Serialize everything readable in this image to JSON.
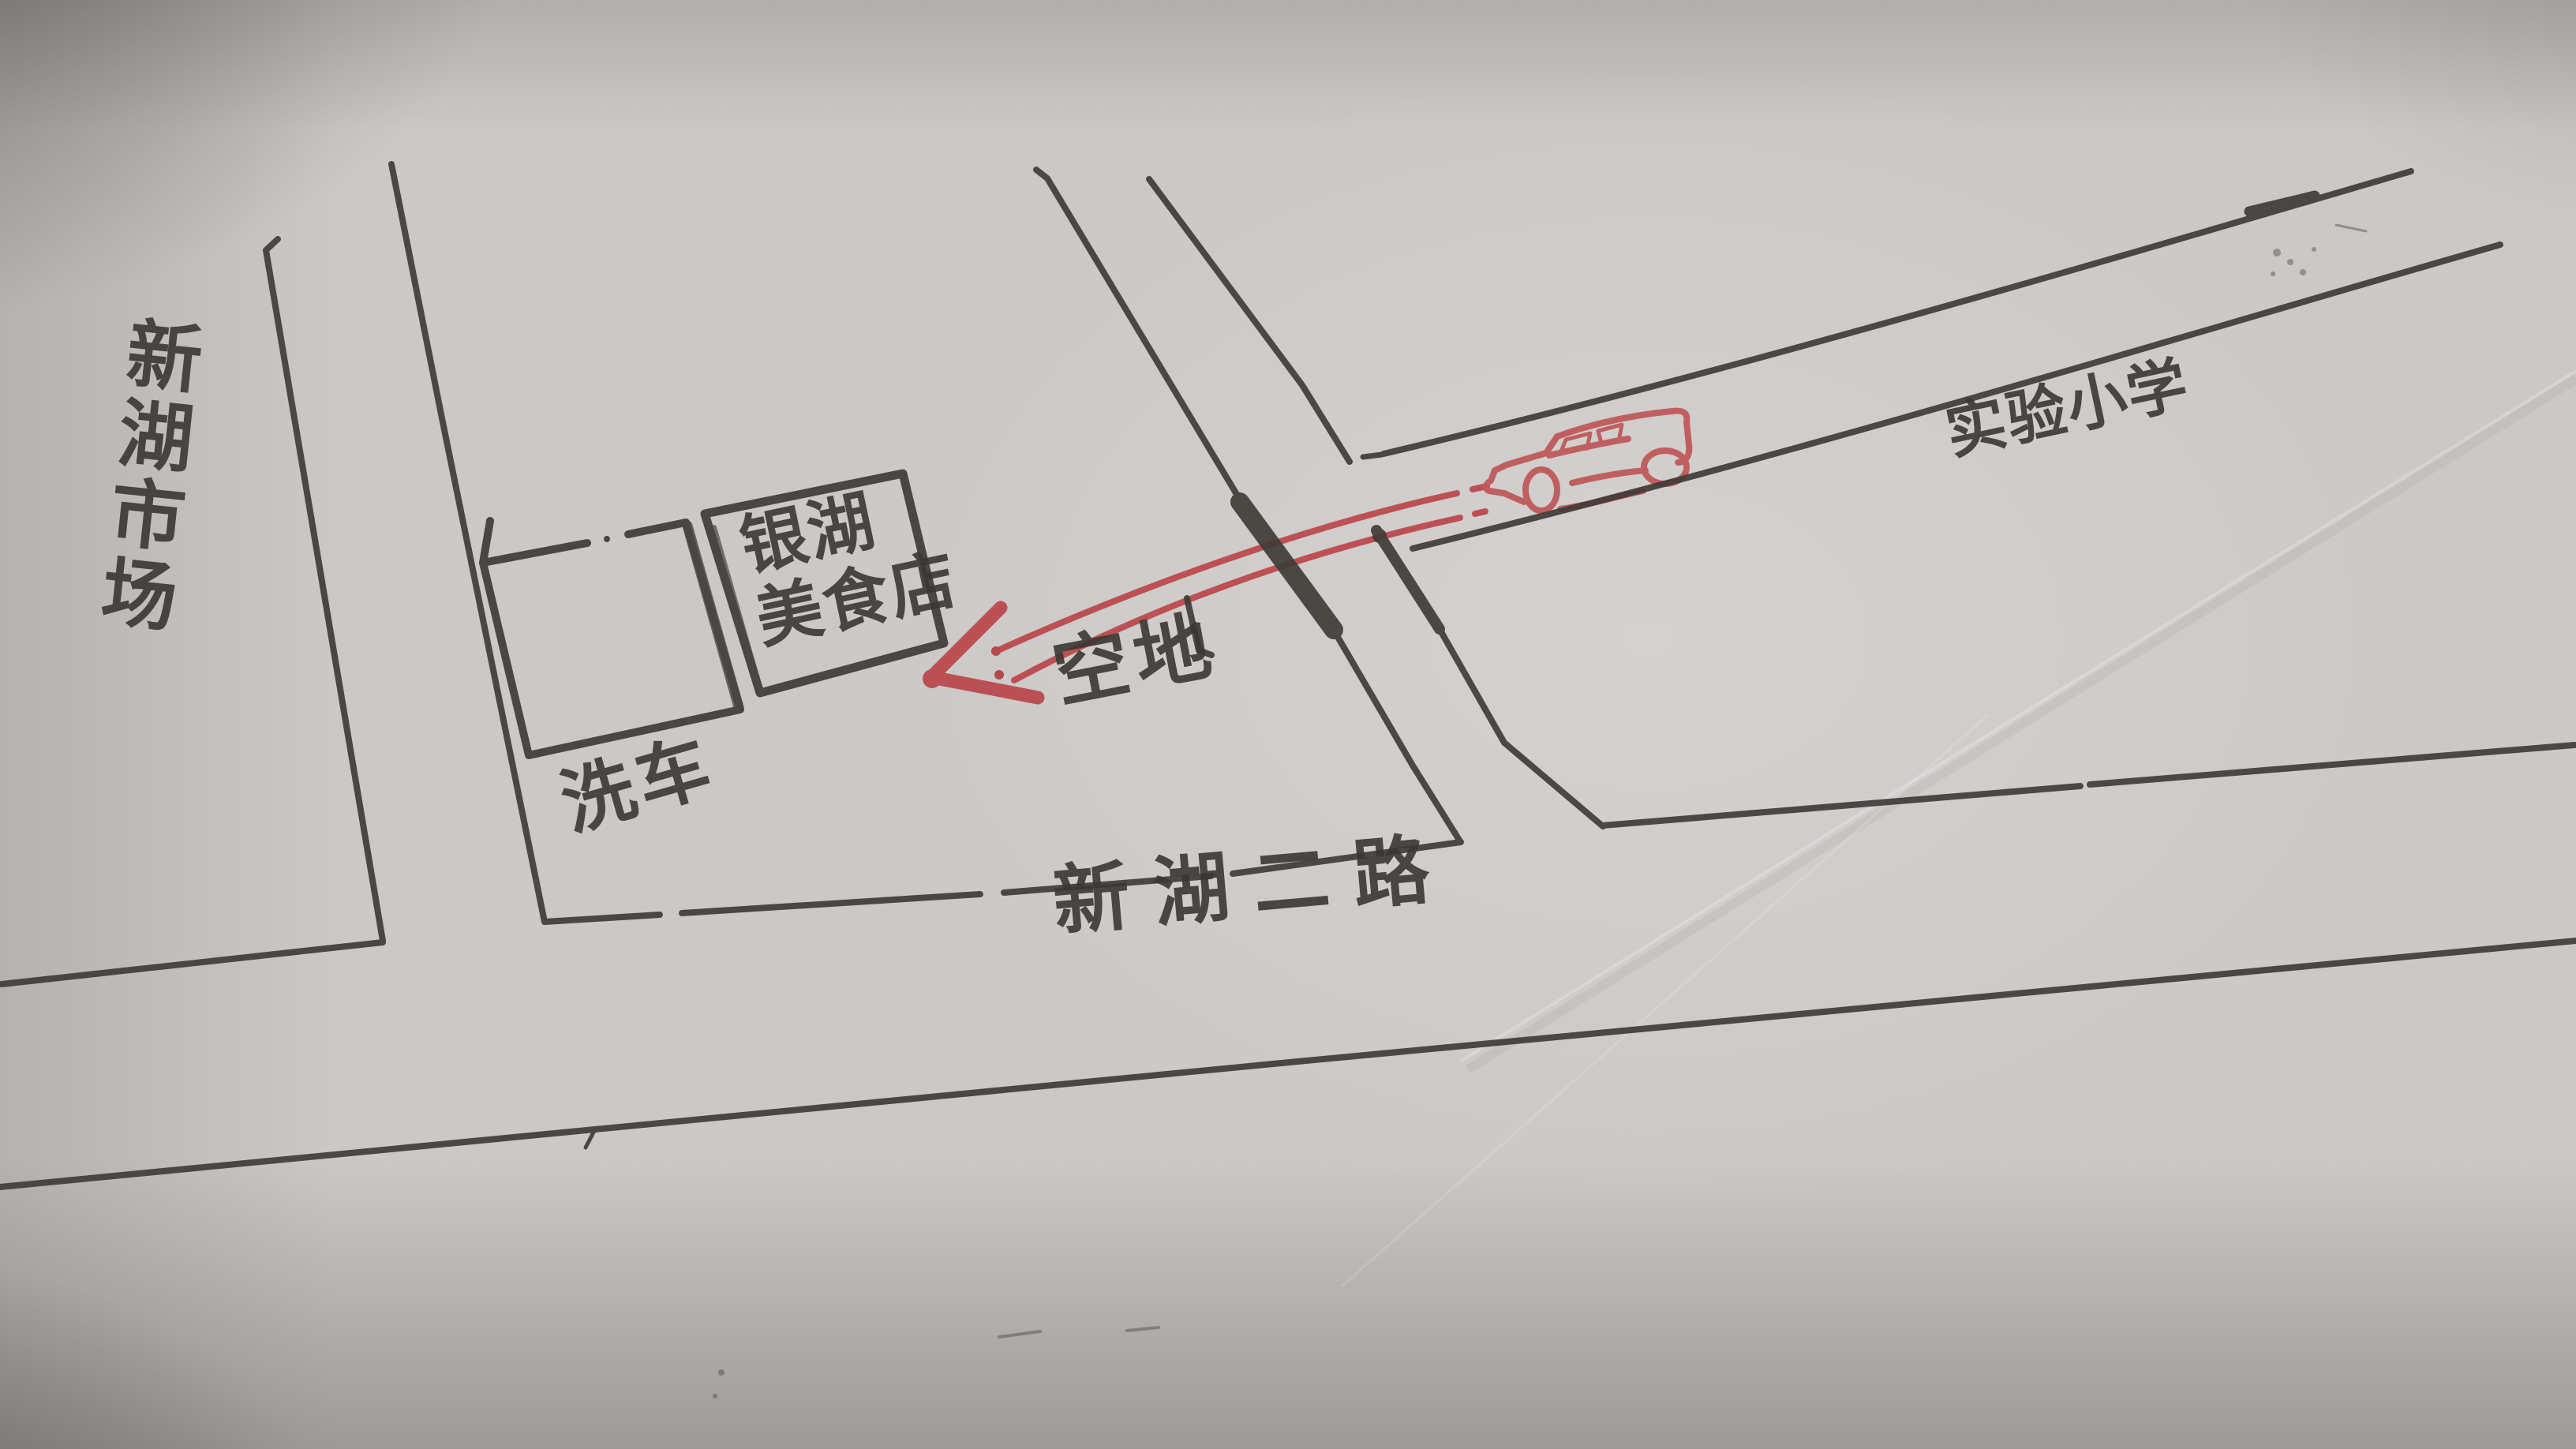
{
  "map": {
    "places": [
      {
        "id": "xinhu-market",
        "label": "新湖市场",
        "orientation": "vertical"
      },
      {
        "id": "car-wash",
        "label": "洗车",
        "shape": "empty-square-outline"
      },
      {
        "id": "yinhu-restaurant",
        "label": "银湖美食店",
        "label_lines": [
          "银湖",
          "美食店"
        ],
        "shape": "square-outline-with-text"
      },
      {
        "id": "empty-lot",
        "label": "空地"
      },
      {
        "id": "experimental-primary-school",
        "label": "实验小学"
      }
    ],
    "roads": [
      {
        "id": "xinhu-2nd-road",
        "label": "新湖二路"
      }
    ],
    "route": {
      "marker_icon": "red-car-sketch",
      "arrow_icon": "red-double-line-arrow-pointing-left"
    },
    "colors": {
      "paper": "#cbc8c6",
      "ink": "#403c38",
      "route_red": "#bb4a4e",
      "car_red": "#c05a5b"
    }
  }
}
